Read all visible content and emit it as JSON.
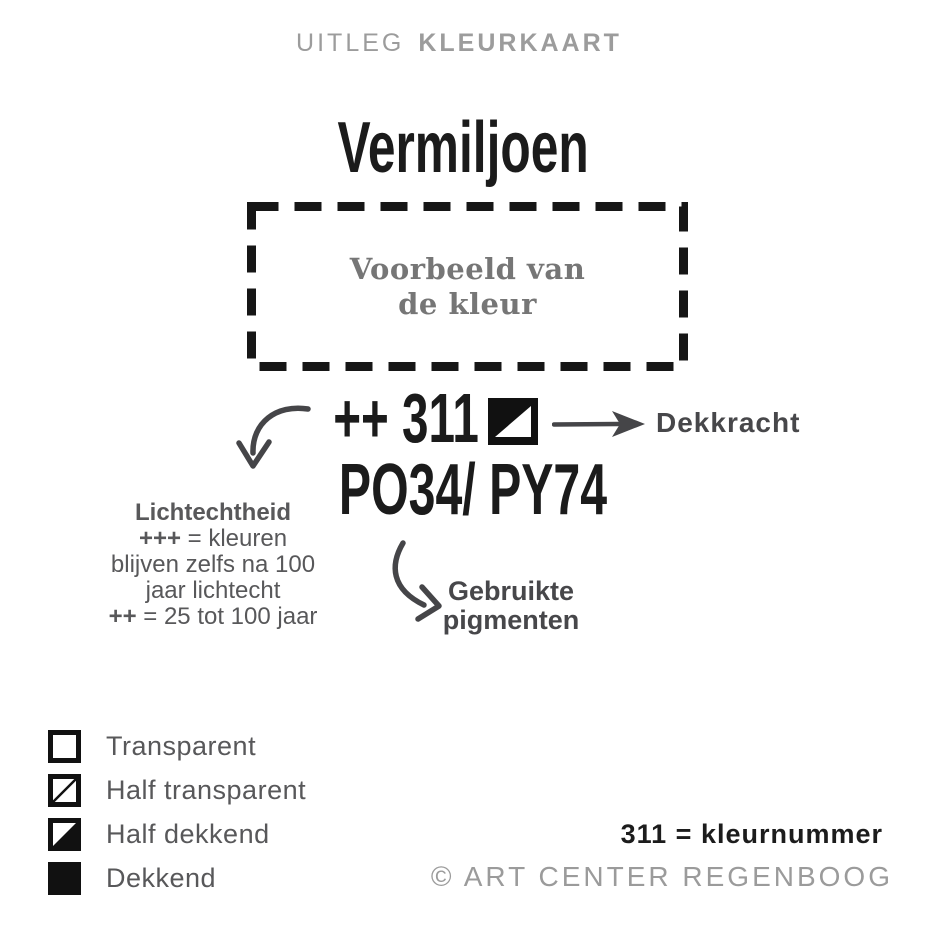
{
  "header": {
    "title_light": "UITLEG",
    "title_bold": "KLEURKAART"
  },
  "sample": {
    "color_name": "Vermiljoen",
    "swatch_placeholder_line1": "Voorbeeld van",
    "swatch_placeholder_line2": "de kleur",
    "lightfastness_and_number": "++ 311",
    "opacity_symbol": "half-dekkend-square",
    "pigments": "PO34/ PY74"
  },
  "annotations": {
    "dekkracht_label": "Dekkracht",
    "lichtechtheid": {
      "heading": "Lichtechtheid",
      "line2_bold": "+++",
      "line2_rest": " = kleuren",
      "line3": "blijven zelfs na 100",
      "line4": "jaar lichtecht",
      "line5_bold": "++",
      "line5_rest": " = 25 tot 100 jaar"
    },
    "pigmenten_line1": "Gebruikte",
    "pigmenten_line2": "pigmenten"
  },
  "legend": {
    "items": [
      {
        "symbol": "empty-square",
        "label": "Transparent"
      },
      {
        "symbol": "diagonal-line-square",
        "label": "Half transparent"
      },
      {
        "symbol": "half-filled-square",
        "label": "Half dekkend"
      },
      {
        "symbol": "filled-square",
        "label": "Dekkend"
      }
    ]
  },
  "footer": {
    "number_note": "311 = kleurnummer",
    "copyright": "© ART CENTER REGENBOOG"
  },
  "colors": {
    "ink_black": "#1b1b1b",
    "title_gray": "#9c9c9c",
    "swatch_text_gray": "#767676",
    "annotation_gray": "#58585a",
    "label_dark_gray": "#47474a",
    "arrow_gray": "#454548",
    "copyright_gray": "#9b9b9b"
  }
}
